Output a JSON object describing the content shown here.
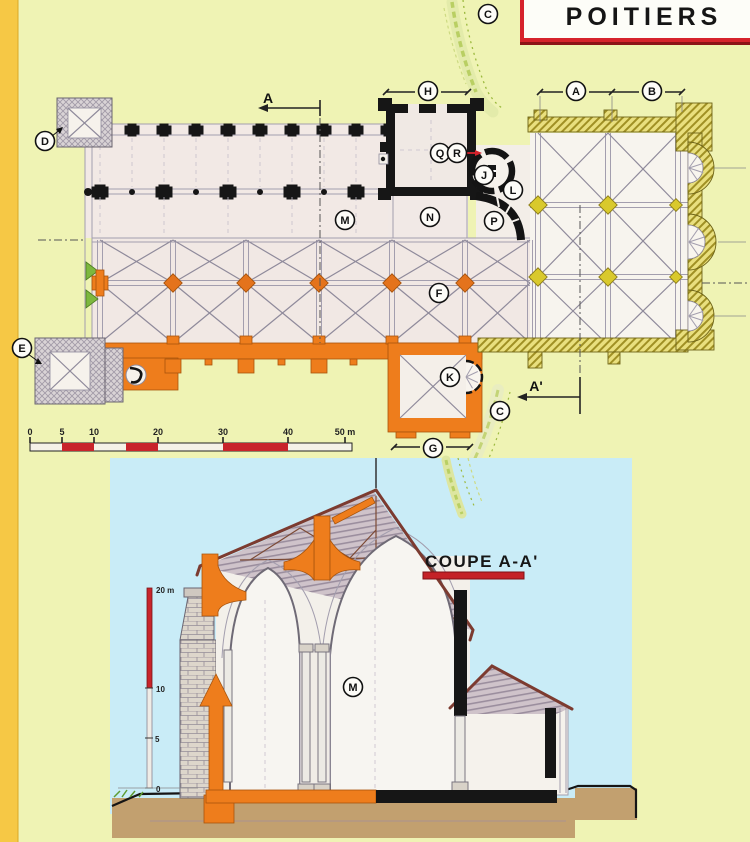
{
  "header": {
    "title": "POITIERS"
  },
  "plan": {
    "section_cut": {
      "top": "A",
      "bottom": "A'"
    },
    "scale_bar": {
      "ticks": [
        "0",
        "5",
        "10",
        "20",
        "30",
        "40",
        "50 m"
      ]
    }
  },
  "section": {
    "title": "COUPE A-A'",
    "scale": {
      "labels": [
        "20 m",
        "10",
        "5",
        "0"
      ]
    }
  },
  "markers": [
    {
      "letter": "C",
      "x": 488,
      "y": 14
    },
    {
      "letter": "D",
      "x": 45,
      "y": 141
    },
    {
      "letter": "E",
      "x": 22,
      "y": 348
    },
    {
      "letter": "H",
      "x": 428,
      "y": 91
    },
    {
      "letter": "A",
      "x": 576,
      "y": 91
    },
    {
      "letter": "B",
      "x": 652,
      "y": 91
    },
    {
      "letter": "Q",
      "x": 440,
      "y": 153
    },
    {
      "letter": "R",
      "x": 457,
      "y": 153
    },
    {
      "letter": "J",
      "x": 484,
      "y": 175
    },
    {
      "letter": "L",
      "x": 513,
      "y": 190
    },
    {
      "letter": "M",
      "x": 345,
      "y": 220
    },
    {
      "letter": "N",
      "x": 430,
      "y": 217
    },
    {
      "letter": "P",
      "x": 494,
      "y": 221
    },
    {
      "letter": "F",
      "x": 439,
      "y": 293
    },
    {
      "letter": "K",
      "x": 450,
      "y": 377
    },
    {
      "letter": "C",
      "x": 500,
      "y": 411
    },
    {
      "letter": "G",
      "x": 433,
      "y": 448
    },
    {
      "letter": "M",
      "x": 353,
      "y": 687
    }
  ],
  "colors": {
    "background": "#eff3b4",
    "left_stripe": "#f6c845",
    "accent_red": "#c8242b",
    "orange": "#ee7d1c",
    "chevet_yellow": "#d9c92c",
    "sky_blue": "#c9ecf7",
    "ground_tan": "#c2a06f",
    "ink_black": "#161616",
    "vegetation_green": "#9cb93f"
  }
}
